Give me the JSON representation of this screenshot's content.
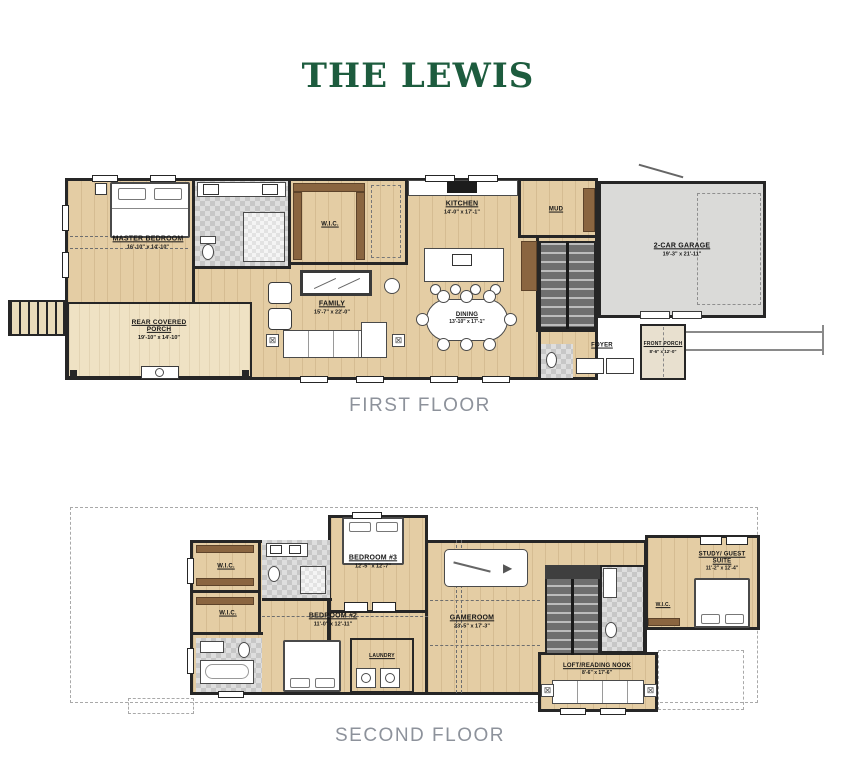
{
  "page": {
    "title": "THE LEWIS"
  },
  "colors": {
    "title_green": "#1d5c3e",
    "caption_gray": "#8d929b",
    "wood_floor": "#e4cda4",
    "porch_wood": "#efe2c4",
    "garage_gray": "#dadad8",
    "wall": "#262626",
    "cabinet_brown": "#8a6540"
  },
  "floors": {
    "first": {
      "caption": "FIRST FLOOR",
      "rooms": {
        "master_bedroom": {
          "name": "MASTER BEDROOM",
          "dims": "16'-10\" x 14'-10\""
        },
        "wic": {
          "name": "W.I.C."
        },
        "kitchen": {
          "name": "KITCHEN",
          "dims": "14'-0\" x 17'-1\""
        },
        "mud": {
          "name": "MUD"
        },
        "garage": {
          "name": "2-CAR GARAGE",
          "dims": "19'-3\" x 21'-11\""
        },
        "family": {
          "name": "FAMILY",
          "dims": "15'-7\" x 22'-0\""
        },
        "dining": {
          "name": "DINING",
          "dims": "13'-10\" x 17'-1\""
        },
        "foyer": {
          "name": "FOYER"
        },
        "front_porch": {
          "name": "FRONT PORCH",
          "dims": "8'-6\" x 12'-0\""
        },
        "rear_porch": {
          "name": "REAR COVERED PORCH",
          "dims": "19'-10\" x 14'-10\""
        }
      }
    },
    "second": {
      "caption": "SECOND FLOOR",
      "rooms": {
        "wic1": {
          "name": "W.I.C."
        },
        "wic2": {
          "name": "W.I.C."
        },
        "wic3": {
          "name": "W.I.C."
        },
        "bedroom3": {
          "name": "BEDROOM #3",
          "dims": "12'-5\" x 12'-7\""
        },
        "bedroom2": {
          "name": "BEDROOM #2",
          "dims": "11'-0\" x 12'-11\""
        },
        "gameroom": {
          "name": "GAMEROOM",
          "dims": "23'-5\" x 17'-3\""
        },
        "laundry": {
          "name": "LAUNDRY"
        },
        "loft": {
          "name": "LOFT/READING NOOK",
          "dims": "8'-6\" x 17'-6\""
        },
        "study": {
          "name": "STUDY/ GUEST SUITE",
          "dims": "11'-2\" x 12'-4\""
        }
      }
    }
  }
}
